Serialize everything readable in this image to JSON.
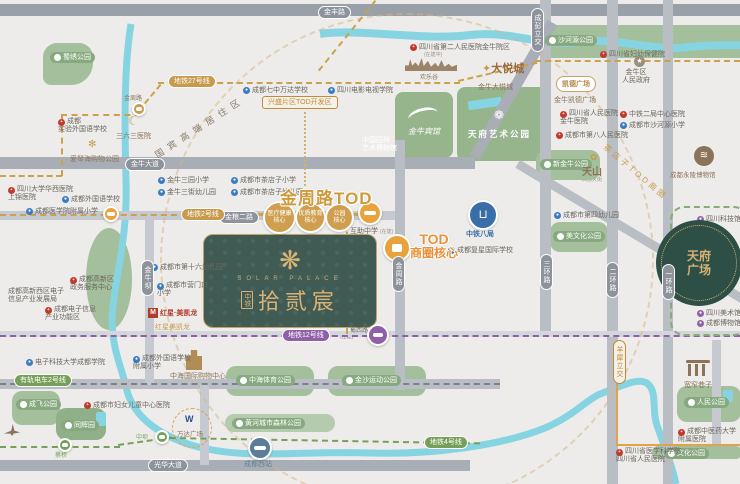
{
  "map": {
    "roads": {
      "jinfeng": "金丰路",
      "jinniu": "金牛大道",
      "jinliang2": "金粮二路",
      "jinzhou": "金周路",
      "shuxi": "蜀西路",
      "guanghua": "光华大道",
      "erhuan": "二环路",
      "yihuan": "一环路",
      "sanhuan": "三环路",
      "jinniuba": "金牛坝",
      "chengpeng_flyover": "成彭立交",
      "yangxi_flyover": "羊犀立交"
    },
    "transit": {
      "line2": "地铁2号线",
      "line27": "地铁27号线",
      "line12": "地铁12号线",
      "line12_note": "(在建)",
      "line4": "地铁4号线",
      "tram2": "有轨电车2号线",
      "st_jinzhoulu": "金周路",
      "st_shuxilu": "蜀西路",
      "st_zhongba": "中坝",
      "st_caiqiao": "蔡桥",
      "west_station": "成都西站"
    },
    "zones": {
      "jinzhou_tod": "金周路TOD",
      "xingsheng": "兴盛片区TOD开发区",
      "guobin": "国宾高端居住区",
      "chadianzi": "茶店子TOD商圈",
      "tod_core": [
        "TOD",
        "商圈核心"
      ],
      "core_medical": [
        "医疗健康",
        "核心"
      ],
      "core_edu": [
        "优质教育",
        "核心"
      ],
      "core_park": [
        "公园",
        "核心"
      ]
    },
    "property": {
      "brand": "中铁",
      "name": "拾贰宸",
      "name_en": "SOLAR PALACE"
    },
    "parks": {
      "shuxiu": "蜀绣公园",
      "shaheyuan": "沙河源公园",
      "tianfu_art": "天府艺术公园",
      "jinniu_hotel": "金牛宾馆",
      "xinjinniu": "新金牛公园",
      "mei": "美文化公园",
      "zhonghai": "中海体育公园",
      "jinsha": "金沙运动公园",
      "huanghe": "黄河城市森林公园",
      "chengfei": "成飞公园",
      "tonghui": "同辉园",
      "renmin": "人民公园",
      "wenhua": "文化公园"
    },
    "pois": {
      "h363": "三六三医院",
      "aegean": "爱琴海购物公园",
      "shiyan_school": [
        "成都",
        "实验外国语学校"
      ],
      "huaxi": [
        "四川大学华西医院",
        "上锦医院"
      ],
      "cfls": "成都外国语学校",
      "cmc_primary": "成都医学院附属小学",
      "qz_wanda": "成都七中万达学校",
      "scftv": "四川电影电视学院",
      "sc2": "四川省第二人民医院金牛院区",
      "sc2_note": "(在建中)",
      "happyvalley": "欢乐谷",
      "joycity_logo": "大悦城",
      "joycity": "金牛大悦城",
      "garden_museum": [
        "中国园林",
        "艺术博物馆"
      ],
      "yongling": "成都永陵博物馆",
      "capitaland_logo": "凯德广场",
      "capitaland": "金牛凯德广场",
      "gov": [
        "金牛区",
        "人民政府"
      ],
      "scfy": "四川省妇幼保健院",
      "sc_renmin_jn": [
        "四川省人民医院",
        "金牛医院"
      ],
      "cd8": "成都市第八人民医院",
      "ztej": "中铁二局中心医院",
      "shahe_primary": "成都市沙河源小学",
      "jn3_primary": "金牛三园小学",
      "jn3_kg": "金牛三街幼儿园",
      "cdz_primary": "成都市茶店子小学",
      "cdz_kg": "成都市茶店子幼儿园",
      "cd4_kg": "成都市第四幼儿园",
      "cd16_kg": "成都市第十六幼儿园",
      "ymk_primary": [
        "成都市营门口",
        "小学"
      ],
      "hongxing_logo": "M",
      "hongxing": "红星·美凯龙",
      "hongxing_sub": "红星美凯龙",
      "gx_service": [
        "成都高新区",
        "政务服务中心"
      ],
      "gx_bureau": [
        "成都高新西区电子",
        "信息产业发展局"
      ],
      "gx_zone": [
        "成都电子信息",
        "产业功能区"
      ],
      "ztbj": "中铁八局",
      "fuxing": "成都复星国际学校",
      "huzhu": "互助中学",
      "huzhu_note": "(在建)",
      "tianshan_logo": "天山",
      "tianshan": "西部天街",
      "keji": "四川科技馆",
      "tianfu_sq": [
        "天府",
        "广场"
      ],
      "art_museum": "四川美术馆",
      "cd_museum": "成都博物馆",
      "kuanzhai": "宽窄巷子",
      "zyy": [
        "成都中医药大学",
        "附属医院"
      ],
      "sc_renmin": [
        "四川省医学科学院",
        "四川省人民医院"
      ],
      "fuyou": "成都市妇女儿童中心医院",
      "uestc": "电子科技大学成都学院",
      "cfls_primary": [
        "成都外国语学校",
        "附属小学"
      ],
      "zhonghai_mall": "中海国际购物中心",
      "wanda": "万达广场"
    }
  }
}
